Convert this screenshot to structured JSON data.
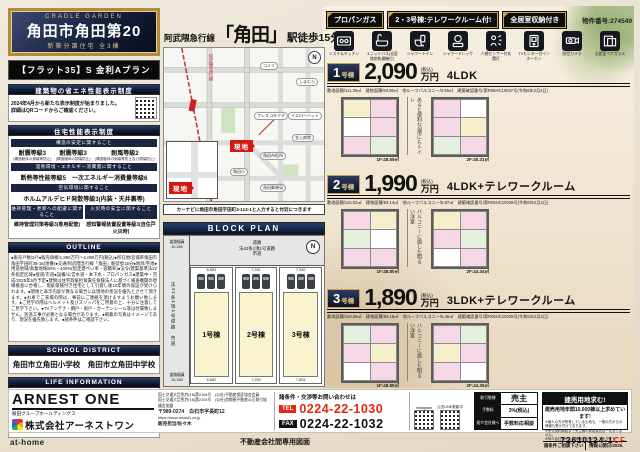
{
  "header": {
    "brand": "CRADLE GARDEN",
    "title": "角田市角田第20",
    "subtitle": "新築分譲住宅 全3棟",
    "flat35": "【フラット35】S 金利Aプラン"
  },
  "energy": {
    "heading": "建築物の省エネ性能表示制度",
    "body": "2024年4月から新たな表示制度が始まりました。\n詳細はQRコードからご確認ください。"
  },
  "performance": {
    "heading": "住宅性能表示制度",
    "sub1": "構造の安定に関すること",
    "g1a": "耐震等級3",
    "g1a_s": "(構造躯体の倒壊等防止)",
    "g1b": "耐震等級3",
    "g1b_s": "(構造躯体の損傷防止)",
    "g1c": "耐風等級2",
    "g1c_s": "(構造躯体の倒壊等防止及び損傷防止)",
    "sub2": "温熱環境・エネルギー消費量に関すること",
    "g2": "断熱等性能等級5　一次エネルギー消費量等級6",
    "sub3": "空気環境に関すること",
    "g3": "ホルムアルデヒド発散等級3(内装・天井裏等)",
    "sub4a": "維持管理・更新への配慮に関すること",
    "sub4b": "火災時の安全に関すること",
    "g4a": "維持管理対策等級3(専用配管)",
    "g4b": "感知警報装置設置等級3(自住戸火災時)"
  },
  "outline": {
    "heading": "OUTLINE",
    "body": "●販売戸数/3戸●販売価格/1,890万円〜2,090万円(税込)●所在地/宮城県角田市角田字田町38-16(地番)●交通/阿武隈急行線「角田」駅徒歩15分●地目/宅地●用途地域/商業地域80%・400%(指定建ぺい率・容積率)●法令/建築基準法22条指定区域●接道/市道●設備/公営水道・本下水・プロパンガス●建築中・完成/2025年5月予定●建物は住宅瑕疵担保責任保険法人に基づく検査機関の現場検査に合格し、瑕疵保険付き住宅として引渡し後10年間の保証が受けられます。●現地と表示内容が異なる場合には現地の状況を優先とさせて頂きます。●お車でご来場の際は、事前にご連絡を頂けますようお願い致します。●ご見学の際はヘルメット及びスリッパをご用意の上、十分に注意してご見学下さい。●TVアンテナ・網戸・雨戸・カーテンレール等は付属致しません。別途工事が必要となる場合があります。●掲載の写真はイメージであり、現況を優先致します。●諸条件はご相談下さい。"
  },
  "school": {
    "heading": "SCHOOL DISTRICT",
    "text": "角田市立角田小学校　角田市立角田中学校"
  },
  "life": {
    "heading": "LIFE INFORMATION",
    "items": [
      {
        "name": "フレスコキクチ角田店",
        "value": "徒歩4分(313m)"
      },
      {
        "name": "セブンイレブン角田西田町店",
        "value": "徒歩2分(108m)"
      },
      {
        "name": "ドラッグストアモリ角田店",
        "value": "徒歩4分(319m)"
      },
      {
        "name": "医療法人金上仁友会金上病院",
        "value": "徒歩6分(438m)"
      },
      {
        "name": "角田郵便局",
        "value": "徒歩4分(306m)"
      }
    ]
  },
  "station": {
    "line": "阿武隈急行線",
    "station": "「角田」",
    "walk": "駅徒歩15分"
  },
  "map": {
    "caption": "カーナビに角田市角田字田町3-113-1と入力すると付近につきます",
    "genchi": "現地",
    "rail": "阿武隈急行線",
    "landmarks": [
      "コメリ",
      "しまむら",
      "フレスコキクチ",
      "イエローハット",
      "角田市役所",
      "金上病院",
      "角田小",
      "角田郵便局"
    ]
  },
  "blockplan": {
    "heading": "BLOCK PLAN",
    "road_top": "道路\n法42条1項1号道路\n市道",
    "road_left": "法42条1項1号道路　市道",
    "width_top": "道路幅員\n10,260",
    "width_bottom": "道路幅員\n10,260",
    "lot1": "1号棟",
    "lot2": "2号棟",
    "lot3": "3号棟",
    "dims_top_1": "6,883",
    "dims_top_2": "7,261",
    "dims_top_3": "7,340",
    "dims_bottom_1": "6,882",
    "dims_bottom_2": "7,250",
    "dims_bottom_3": "7,804",
    "north": "N"
  },
  "badges": {
    "b1": "プロパンガス",
    "b2": "2・3号棟:テレワークルーム付!",
    "b3": "全居室収納付き",
    "property_no": "物件番号:274549"
  },
  "features": [
    "システムキッチン",
    "ユニットバス(浴室換気乾燥機付)",
    "シャワートイレ",
    "シャワードレッサー",
    "人感センサー付玄関灯",
    "TVモニター付インターホン",
    "防犯カメラ",
    "全居室ペアガラス"
  ],
  "units": [
    {
      "no": "1",
      "suffix": "号棟",
      "price": "2,090",
      "tax": "(税込)",
      "man": "万円",
      "layout": "4LDK",
      "details": "敷地面積/111.35㎡　建物面積/93.96㎡　他ルーフバルコニー/4.56㎡　建築確認番号/第R06HC10037号(令和6年2月4日)",
      "area1": "1F:48.65㎡",
      "area2": "2F:45.31㎡",
      "note": "あると便利な2階にもトイレ"
    },
    {
      "no": "2",
      "suffix": "号棟",
      "price": "1,990",
      "tax": "(税込)",
      "man": "万円",
      "layout": "4LDK+テレワークルーム",
      "details": "敷地面積/115.02㎡　建物面積/93.14㎡　他ルーフバルコニー/5.87㎡　建築確認番号/第R06HC10036号(令和6年2月4日)",
      "area1": "1F:48.80㎡",
      "area2": "2F:44.34㎡",
      "note": "バルコニーに面した明るい洋室"
    },
    {
      "no": "3",
      "suffix": "号棟",
      "price": "1,890",
      "tax": "(税込)",
      "man": "万円",
      "layout": "3LDK+テレワークルーム",
      "details": "敷地面積/119.06㎡　建物面積/93.15㎡　他ルーフバルコニー/5.46㎡　建築確認番号/第R06HC10035号(令和6年2月4日)",
      "area1": "1F:48.80㎡",
      "area2": "2F:44.35㎡",
      "note": "バルコニーに面した明るい洋室"
    }
  ],
  "company": {
    "logo": "ARNEST ONE",
    "group": "飯田グループホールディングス",
    "name": "株式会社アーネストワン",
    "license1": "国土交通大臣免許(16)第2106号　(公社)不動産保証協会会員",
    "license2": "国土交通大臣免許(16)第2104号　(公社)首都圏不動産公正取引協議会加盟",
    "address": "〒989-0274　白石市字長町12",
    "url": "https://www.arnest1.co.jp",
    "staff": "販売担当/佐々木"
  },
  "contact": {
    "heading": "諸条件・交渉等お問い合わせは",
    "tel_label": "TEL",
    "tel": "0224-22-1030",
    "fax_label": "FAX",
    "fax": "0224-22-1032"
  },
  "qr": {
    "instagram": "Instagram",
    "line": "公式LINE更新中"
  },
  "dealer": {
    "r1l": "取引態様",
    "r1v": "売主",
    "r2l": "手数料",
    "r2v": "3%(税込)",
    "r3l": "紹介会社様へ",
    "r3v": "手数料応相談"
  },
  "recruit": {
    "title": "建売用地求む!",
    "lead": "建売用地年間10,000棟以上求めています!",
    "body": "※個人の方が所有している土地も、一般の方からの情報も受け付けております。\n※売買契約締結まで売主様の費用負担は一切ありません。\n※仲介会社様からの情報もお待ちしております。",
    "footer_l": "諸条件ご相談下さい",
    "footer_r": "情報公開日/2026."
  },
  "footer": {
    "athome": "at-home",
    "internal": "不動産会社間専用図面",
    "code_main": "72610124-1",
    "code_suffix": "CF"
  }
}
